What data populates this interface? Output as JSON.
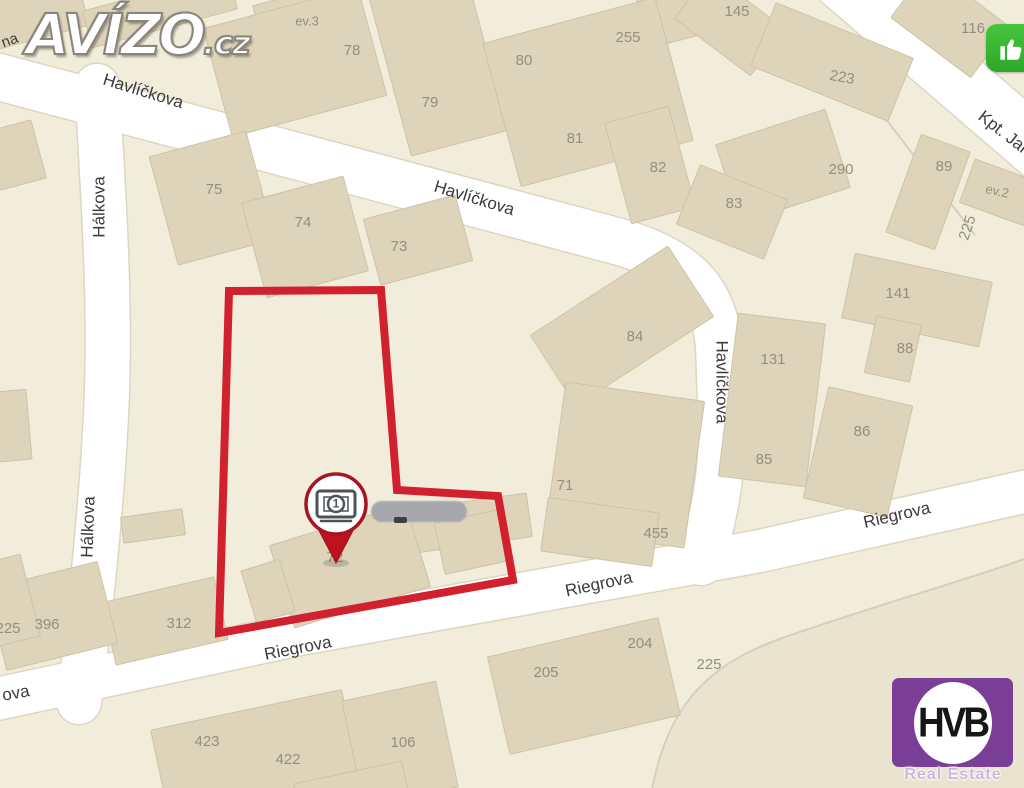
{
  "page": {
    "width": 1024,
    "height": 788
  },
  "branding": {
    "avizo": {
      "name": "AVÍZO",
      "tld": ".cz"
    },
    "hvb": {
      "name": "HVB",
      "subtitle": "Real Estate",
      "bg_color": "#7a3e97"
    },
    "like_button": {
      "icon": "thumbs-up-icon",
      "bg_color": "#35b52f"
    }
  },
  "map": {
    "bg_color": "#f2ecda",
    "street_color": "#ffffff",
    "street_casing_color": "#dcd6c3",
    "building_fill": "#ded4ba",
    "building_stroke": "#cdc3a7",
    "street_label_color": "#3b3b3b",
    "number_color": "#958f7d",
    "selection_color": "#d2212e",
    "streets": [
      {
        "name": "Havlíčkova",
        "path": "M -20 72 L 620 242 C 690 262 714 295 719 345 L 722 430 C 722 482 712 522 701 562",
        "width": 46
      },
      {
        "name": "Hálkova",
        "path": "M 97 86 C 104 200 110 300 107 390 C 104 480 92 600 79 702",
        "width": 44
      },
      {
        "name": "Riegrova",
        "path": "M -22 703 L 300 634 L 560 587 L 760 551 L 1050 486",
        "width": 42
      },
      {
        "name": "Kpt. Jaroše",
        "path": "M 830 -30 L 1066 173",
        "width": 58
      }
    ],
    "street_labels": [
      {
        "text": "Havlíčkova",
        "x": 143,
        "y": 92,
        "rot": 17,
        "size": 17
      },
      {
        "text": "Havlíčkova",
        "x": 474,
        "y": 199,
        "rot": 17,
        "size": 17
      },
      {
        "text": "Havlíčkova",
        "x": 721,
        "y": 382,
        "rot": 90,
        "size": 17
      },
      {
        "text": "Hálkova",
        "x": 100,
        "y": 207,
        "rot": -90,
        "size": 17
      },
      {
        "text": "Hálkova",
        "x": 89,
        "y": 527,
        "rot": -88,
        "size": 17
      },
      {
        "text": "Riegrova",
        "x": 298,
        "y": 649,
        "rot": -11,
        "size": 17
      },
      {
        "text": "Riegrova",
        "x": 599,
        "y": 585,
        "rot": -12,
        "size": 17
      },
      {
        "text": "Riegrova",
        "x": 897,
        "y": 516,
        "rot": -13,
        "size": 17
      },
      {
        "text": "Kpt. Jar",
        "x": 1003,
        "y": 133,
        "rot": 38,
        "size": 17
      },
      {
        "text": "na",
        "x": 10,
        "y": 41,
        "rot": -20,
        "size": 15
      },
      {
        "text": "ova",
        "x": 16,
        "y": 694,
        "rot": -10,
        "size": 17
      }
    ],
    "building_numbers": [
      {
        "text": "78",
        "x": 352,
        "y": 51
      },
      {
        "text": "79",
        "x": 430,
        "y": 103
      },
      {
        "text": "80",
        "x": 524,
        "y": 61
      },
      {
        "text": "81",
        "x": 575,
        "y": 139
      },
      {
        "text": "82",
        "x": 658,
        "y": 168
      },
      {
        "text": "255",
        "x": 628,
        "y": 38
      },
      {
        "text": "ev.3",
        "x": 307,
        "y": 22,
        "size": 13
      },
      {
        "text": "145",
        "x": 737,
        "y": 12
      },
      {
        "text": "116",
        "x": 973,
        "y": 29
      },
      {
        "text": "223",
        "x": 842,
        "y": 78,
        "rot": 10
      },
      {
        "text": "290",
        "x": 841,
        "y": 170
      },
      {
        "text": "89",
        "x": 944,
        "y": 167
      },
      {
        "text": "ev.2",
        "x": 997,
        "y": 192,
        "rot": 12,
        "size": 13
      },
      {
        "text": "225",
        "x": 968,
        "y": 228,
        "rot": -72
      },
      {
        "text": "83",
        "x": 734,
        "y": 204
      },
      {
        "text": "141",
        "x": 898,
        "y": 294
      },
      {
        "text": "88",
        "x": 905,
        "y": 349
      },
      {
        "text": "131",
        "x": 773,
        "y": 360
      },
      {
        "text": "86",
        "x": 862,
        "y": 432
      },
      {
        "text": "85",
        "x": 764,
        "y": 460
      },
      {
        "text": "84",
        "x": 635,
        "y": 337
      },
      {
        "text": "75",
        "x": 214,
        "y": 190
      },
      {
        "text": "74",
        "x": 303,
        "y": 223
      },
      {
        "text": "73",
        "x": 399,
        "y": 247
      },
      {
        "text": "71",
        "x": 565,
        "y": 486
      },
      {
        "text": "455",
        "x": 656,
        "y": 534
      },
      {
        "text": "72",
        "x": 335,
        "y": 558
      },
      {
        "text": "312",
        "x": 179,
        "y": 624
      },
      {
        "text": "396",
        "x": 47,
        "y": 625
      },
      {
        "text": "225",
        "x": 8,
        "y": 629
      },
      {
        "text": "423",
        "x": 207,
        "y": 742
      },
      {
        "text": "422",
        "x": 288,
        "y": 760
      },
      {
        "text": "106",
        "x": 403,
        "y": 743
      },
      {
        "text": "205",
        "x": 546,
        "y": 673
      },
      {
        "text": "204",
        "x": 640,
        "y": 644
      },
      {
        "text": "225",
        "x": 709,
        "y": 665
      }
    ],
    "buildings": [
      [
        30,
        16,
        110,
        48,
        -15
      ],
      [
        160,
        10,
        150,
        38,
        -15
      ],
      [
        300,
        16,
        86,
        44,
        -15
      ],
      [
        673,
        12,
        64,
        58,
        -15
      ],
      [
        295,
        62,
        160,
        112,
        -15
      ],
      [
        438,
        62,
        100,
        168,
        -15
      ],
      [
        588,
        92,
        178,
        148,
        -15
      ],
      [
        650,
        165,
        66,
        104,
        -15
      ],
      [
        212,
        198,
        100,
        112,
        -15
      ],
      [
        305,
        237,
        105,
        98,
        -15
      ],
      [
        418,
        240,
        95,
        68,
        -15
      ],
      [
        730,
        24,
        95,
        58,
        37
      ],
      [
        950,
        22,
        100,
        64,
        37
      ],
      [
        832,
        62,
        148,
        68,
        22
      ],
      [
        783,
        166,
        115,
        82,
        -18
      ],
      [
        732,
        212,
        94,
        64,
        22
      ],
      [
        928,
        192,
        52,
        104,
        20
      ],
      [
        1004,
        194,
        78,
        46,
        20
      ],
      [
        917,
        300,
        140,
        66,
        12
      ],
      [
        893,
        349,
        46,
        58,
        12
      ],
      [
        858,
        452,
        86,
        114,
        13
      ],
      [
        772,
        400,
        88,
        164,
        7
      ],
      [
        622,
        326,
        164,
        84,
        -33
      ],
      [
        625,
        465,
        140,
        148,
        8
      ],
      [
        600,
        532,
        112,
        54,
        8
      ],
      [
        450,
        526,
        160,
        44,
        -8
      ],
      [
        350,
        566,
        142,
        86,
        -17
      ],
      [
        268,
        591,
        40,
        54,
        -17
      ],
      [
        472,
        542,
        66,
        52,
        -12
      ],
      [
        165,
        621,
        115,
        64,
        -13
      ],
      [
        52,
        616,
        114,
        84,
        -14
      ],
      [
        6,
        601,
        50,
        84,
        -14
      ],
      [
        255,
        752,
        195,
        86,
        -12
      ],
      [
        400,
        744,
        96,
        108,
        -12
      ],
      [
        584,
        686,
        175,
        100,
        -13
      ],
      [
        352,
        792,
        110,
        40,
        -12
      ],
      [
        8,
        426,
        42,
        70,
        -5
      ],
      [
        153,
        526,
        62,
        26,
        -8
      ],
      [
        12,
        156,
        55,
        60,
        -15
      ]
    ],
    "parcel_lines": [
      "M 862 88 L 975 235",
      "M 652 790 C 668 706 706 664 788 636 C 880 604 980 576 1032 556"
    ],
    "tint_area": {
      "path": "M 652 790 C 668 706 706 664 788 636 C 880 604 980 576 1032 556 L 1032 790 Z",
      "fill": "#e9e3d0"
    },
    "selection": {
      "points": [
        [
          229,
          291
        ],
        [
          381,
          290
        ],
        [
          397,
          490
        ],
        [
          498,
          496
        ],
        [
          513,
          580
        ],
        [
          219,
          633
        ]
      ],
      "stroke_width": 8
    },
    "pin": {
      "x": 336,
      "y": 504,
      "radius": 30,
      "label": "1",
      "border_color": "#a81521",
      "tip_color": "#bf1220",
      "icon": "banknote-icon",
      "icon_color": "#4e525a"
    },
    "redacted": {
      "x": 371,
      "y": 501,
      "w": 96,
      "h": 21,
      "color": "#a6a8ad"
    }
  }
}
